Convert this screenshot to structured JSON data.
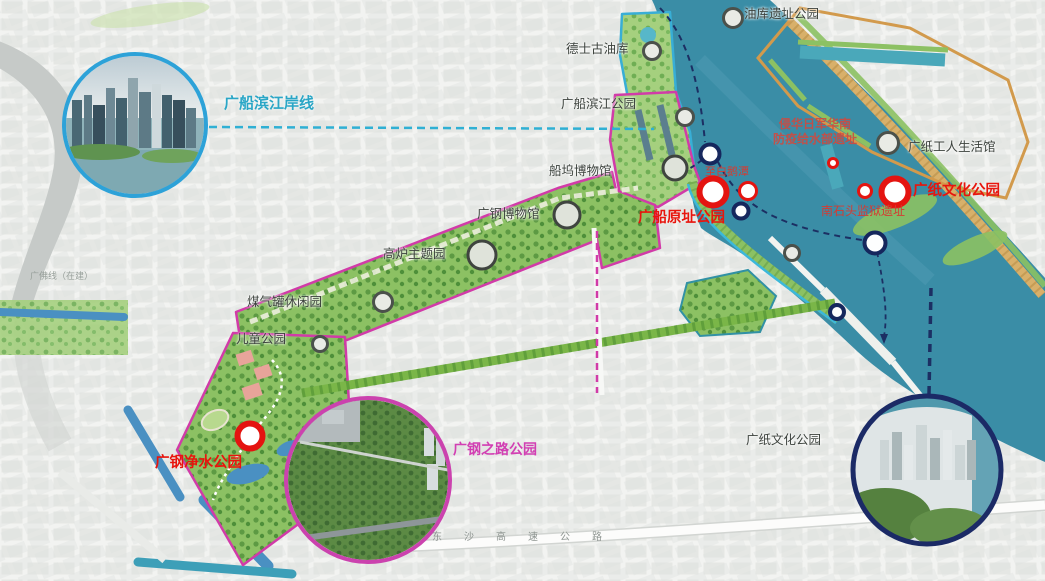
{
  "palette": {
    "water": "#3a8da6",
    "park_green": "#8cc163",
    "park_green_light": "#a5d07e",
    "boundary_magenta": "#d13ba8",
    "boundary_orange": "#d29a4c",
    "boundary_cyan": "#38aed6",
    "route_navy": "#1c2f63",
    "marker_red": "#e41410",
    "label_red": "#e8150d",
    "label_cyan": "#2aa6c6",
    "label_magenta": "#d23fb3",
    "canal_blue": "#4a90c2",
    "base_gray": "#f0f1ee"
  },
  "labels": {
    "oil_depot_ruins_park": {
      "text": "油库遗址公园"
    },
    "texaco_oil_depot": {
      "text": "德士古油库"
    },
    "gc_riverside_park": {
      "text": "广船滨江公园"
    },
    "dock_museum": {
      "text": "船坞博物馆"
    },
    "gg_steel_museum": {
      "text": "广钢博物馆"
    },
    "blast_furnace_park": {
      "text": "高炉主题园"
    },
    "gas_tank_leisure_park": {
      "text": "煤气罐休闲园"
    },
    "children_park": {
      "text": "儿童公园"
    },
    "paper_workers_hall": {
      "text": "广纸工人生活馆"
    },
    "paper_culture_park": {
      "text": "广纸文化公园"
    },
    "gc_riverside_shoreline": {
      "text": "广船滨江岸线"
    },
    "gc_original_site_park": {
      "text": "广船原址公园"
    },
    "to_baietan": {
      "text": "至白鹅潭"
    },
    "japanese_site": {
      "line1": "侵华日军华南",
      "line2": "防疫给水部遗址"
    },
    "nanshitou_prison_site": {
      "text": "南石头监狱遗址"
    },
    "paper_culture_park_marker": {
      "text": "广纸文化公园"
    },
    "gc_water_purify_park": {
      "text": "广钢净水公园"
    },
    "gg_road_park": {
      "text": "广钢之路公园"
    },
    "metro_note": {
      "text": "广佛线（在建）"
    },
    "expressway": {
      "text": "东沙高速公路"
    }
  },
  "icons": {
    "park_node_marker": "gray-ring-circle",
    "ferry_node_marker": "navy-ring-circle",
    "key_park_marker": "red-ring-circle-large",
    "heritage_site_marker": "red-ring-circle-small",
    "water_route": "navy-dashed-arc",
    "shoreline_leader": "cyan-dashed-line",
    "park_link": "magenta-dashed-line",
    "photo_inset_riverside": "circular-photo-blue-ring",
    "photo_inset_gg_road_park": "circular-photo-magenta-ring",
    "photo_inset_paper_park": "circular-photo-navy-ring"
  }
}
